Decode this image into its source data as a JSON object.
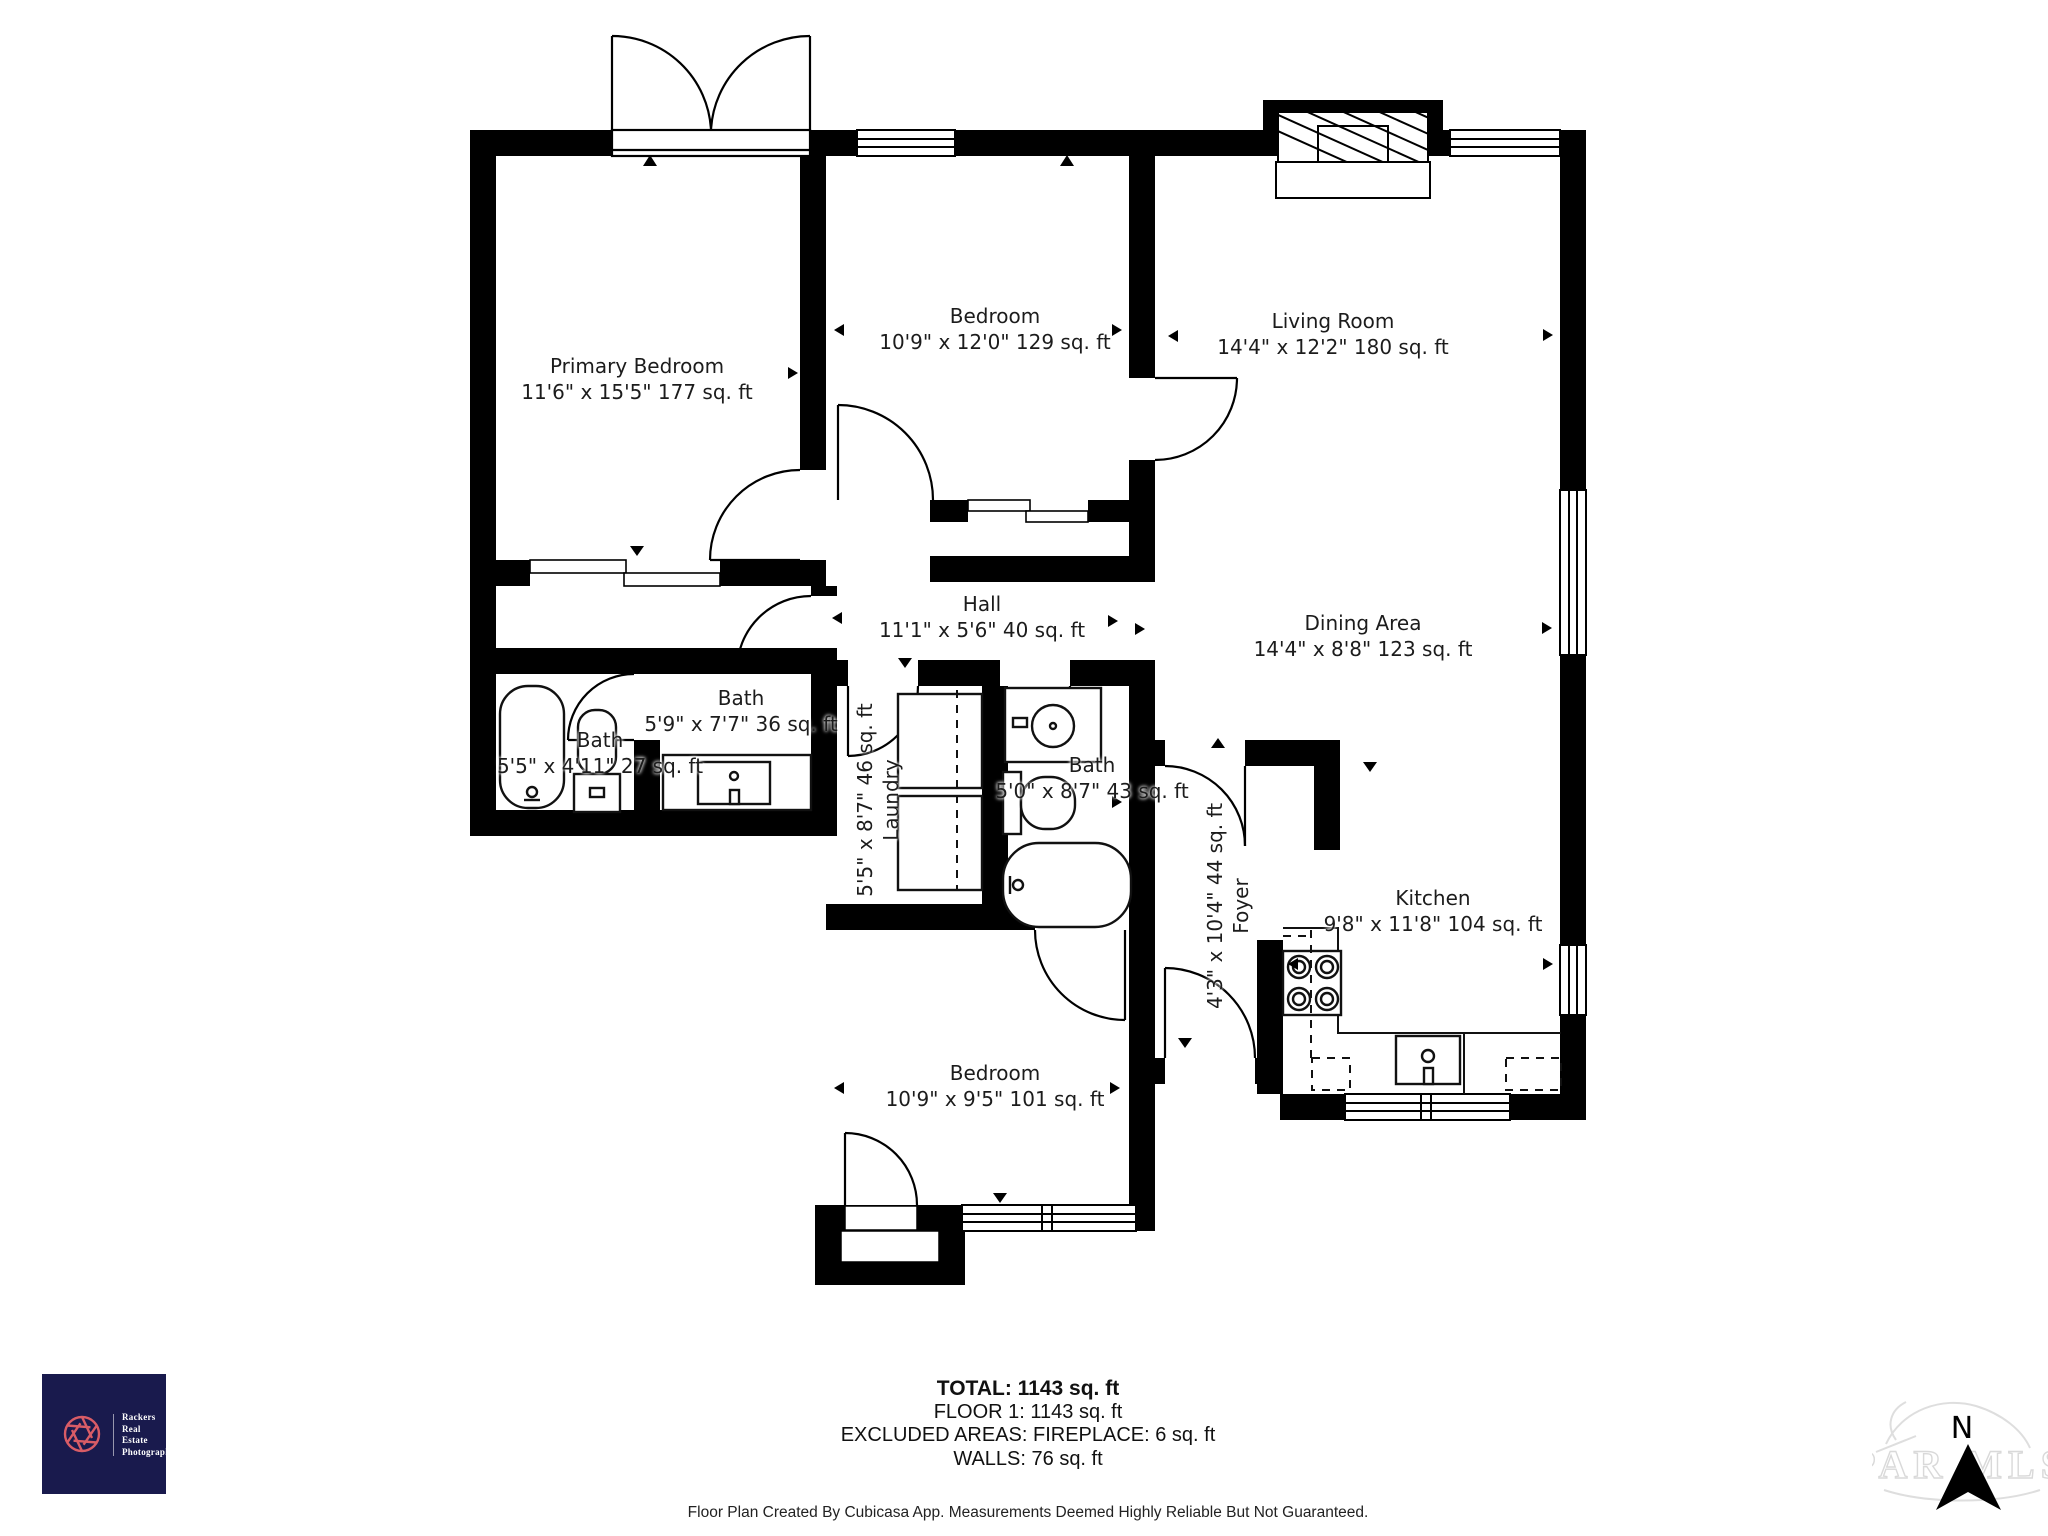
{
  "rooms": {
    "primary_bedroom": {
      "name": "Primary Bedroom",
      "dims": "11'6\" x 15'5\" 177 sq. ft"
    },
    "bedroom_top": {
      "name": "Bedroom",
      "dims": "10'9\" x 12'0\" 129 sq. ft"
    },
    "living_room": {
      "name": "Living Room",
      "dims": "14'4\" x 12'2\" 180 sq. ft"
    },
    "hall": {
      "name": "Hall",
      "dims": "11'1\" x 5'6\" 40 sq. ft"
    },
    "dining_area": {
      "name": "Dining Area",
      "dims": "14'4\" x 8'8\" 123 sq. ft"
    },
    "bath_left": {
      "name": "Bath",
      "dims": "5'5\" x 4'11\" 27 sq. ft"
    },
    "bath_hall": {
      "name": "Bath",
      "dims": "5'9\" x 7'7\" 36 sq. ft"
    },
    "laundry": {
      "name": "Laundry",
      "dims": "5'5\" x 8'7\" 46 sq. ft"
    },
    "bath_middle": {
      "name": "Bath",
      "dims": "5'0\" x 8'7\" 43 sq. ft"
    },
    "foyer": {
      "name": "Foyer",
      "dims": "4'3\" x 10'4\" 44 sq. ft"
    },
    "kitchen": {
      "name": "Kitchen",
      "dims": "9'8\" x 11'8\" 104 sq. ft"
    },
    "bedroom_bottom": {
      "name": "Bedroom",
      "dims": "10'9\" x 9'5\" 101 sq. ft"
    }
  },
  "summary": {
    "total": "TOTAL: 1143 sq. ft",
    "floor": "FLOOR 1: 1143 sq. ft",
    "excluded": "EXCLUDED AREAS: FIREPLACE: 6 sq. ft",
    "walls": "WALLS: 76 sq. ft"
  },
  "footer": {
    "disclaimer": "Floor Plan Created By Cubicasa App. Measurements Deemed Highly Reliable But Not Guaranteed."
  },
  "logo": {
    "line1": "Rackers",
    "line2": "Real",
    "line3": "Estate",
    "line4": "Photography",
    "background": "#191a4d",
    "accent": "#d85c66",
    "text_color": "#ffffff"
  },
  "compass": {
    "north_label": "N",
    "watermark_text": "PAR MLS"
  },
  "colors": {
    "wall": "#000000",
    "background": "#ffffff",
    "label_text": "#1c1c1c"
  }
}
